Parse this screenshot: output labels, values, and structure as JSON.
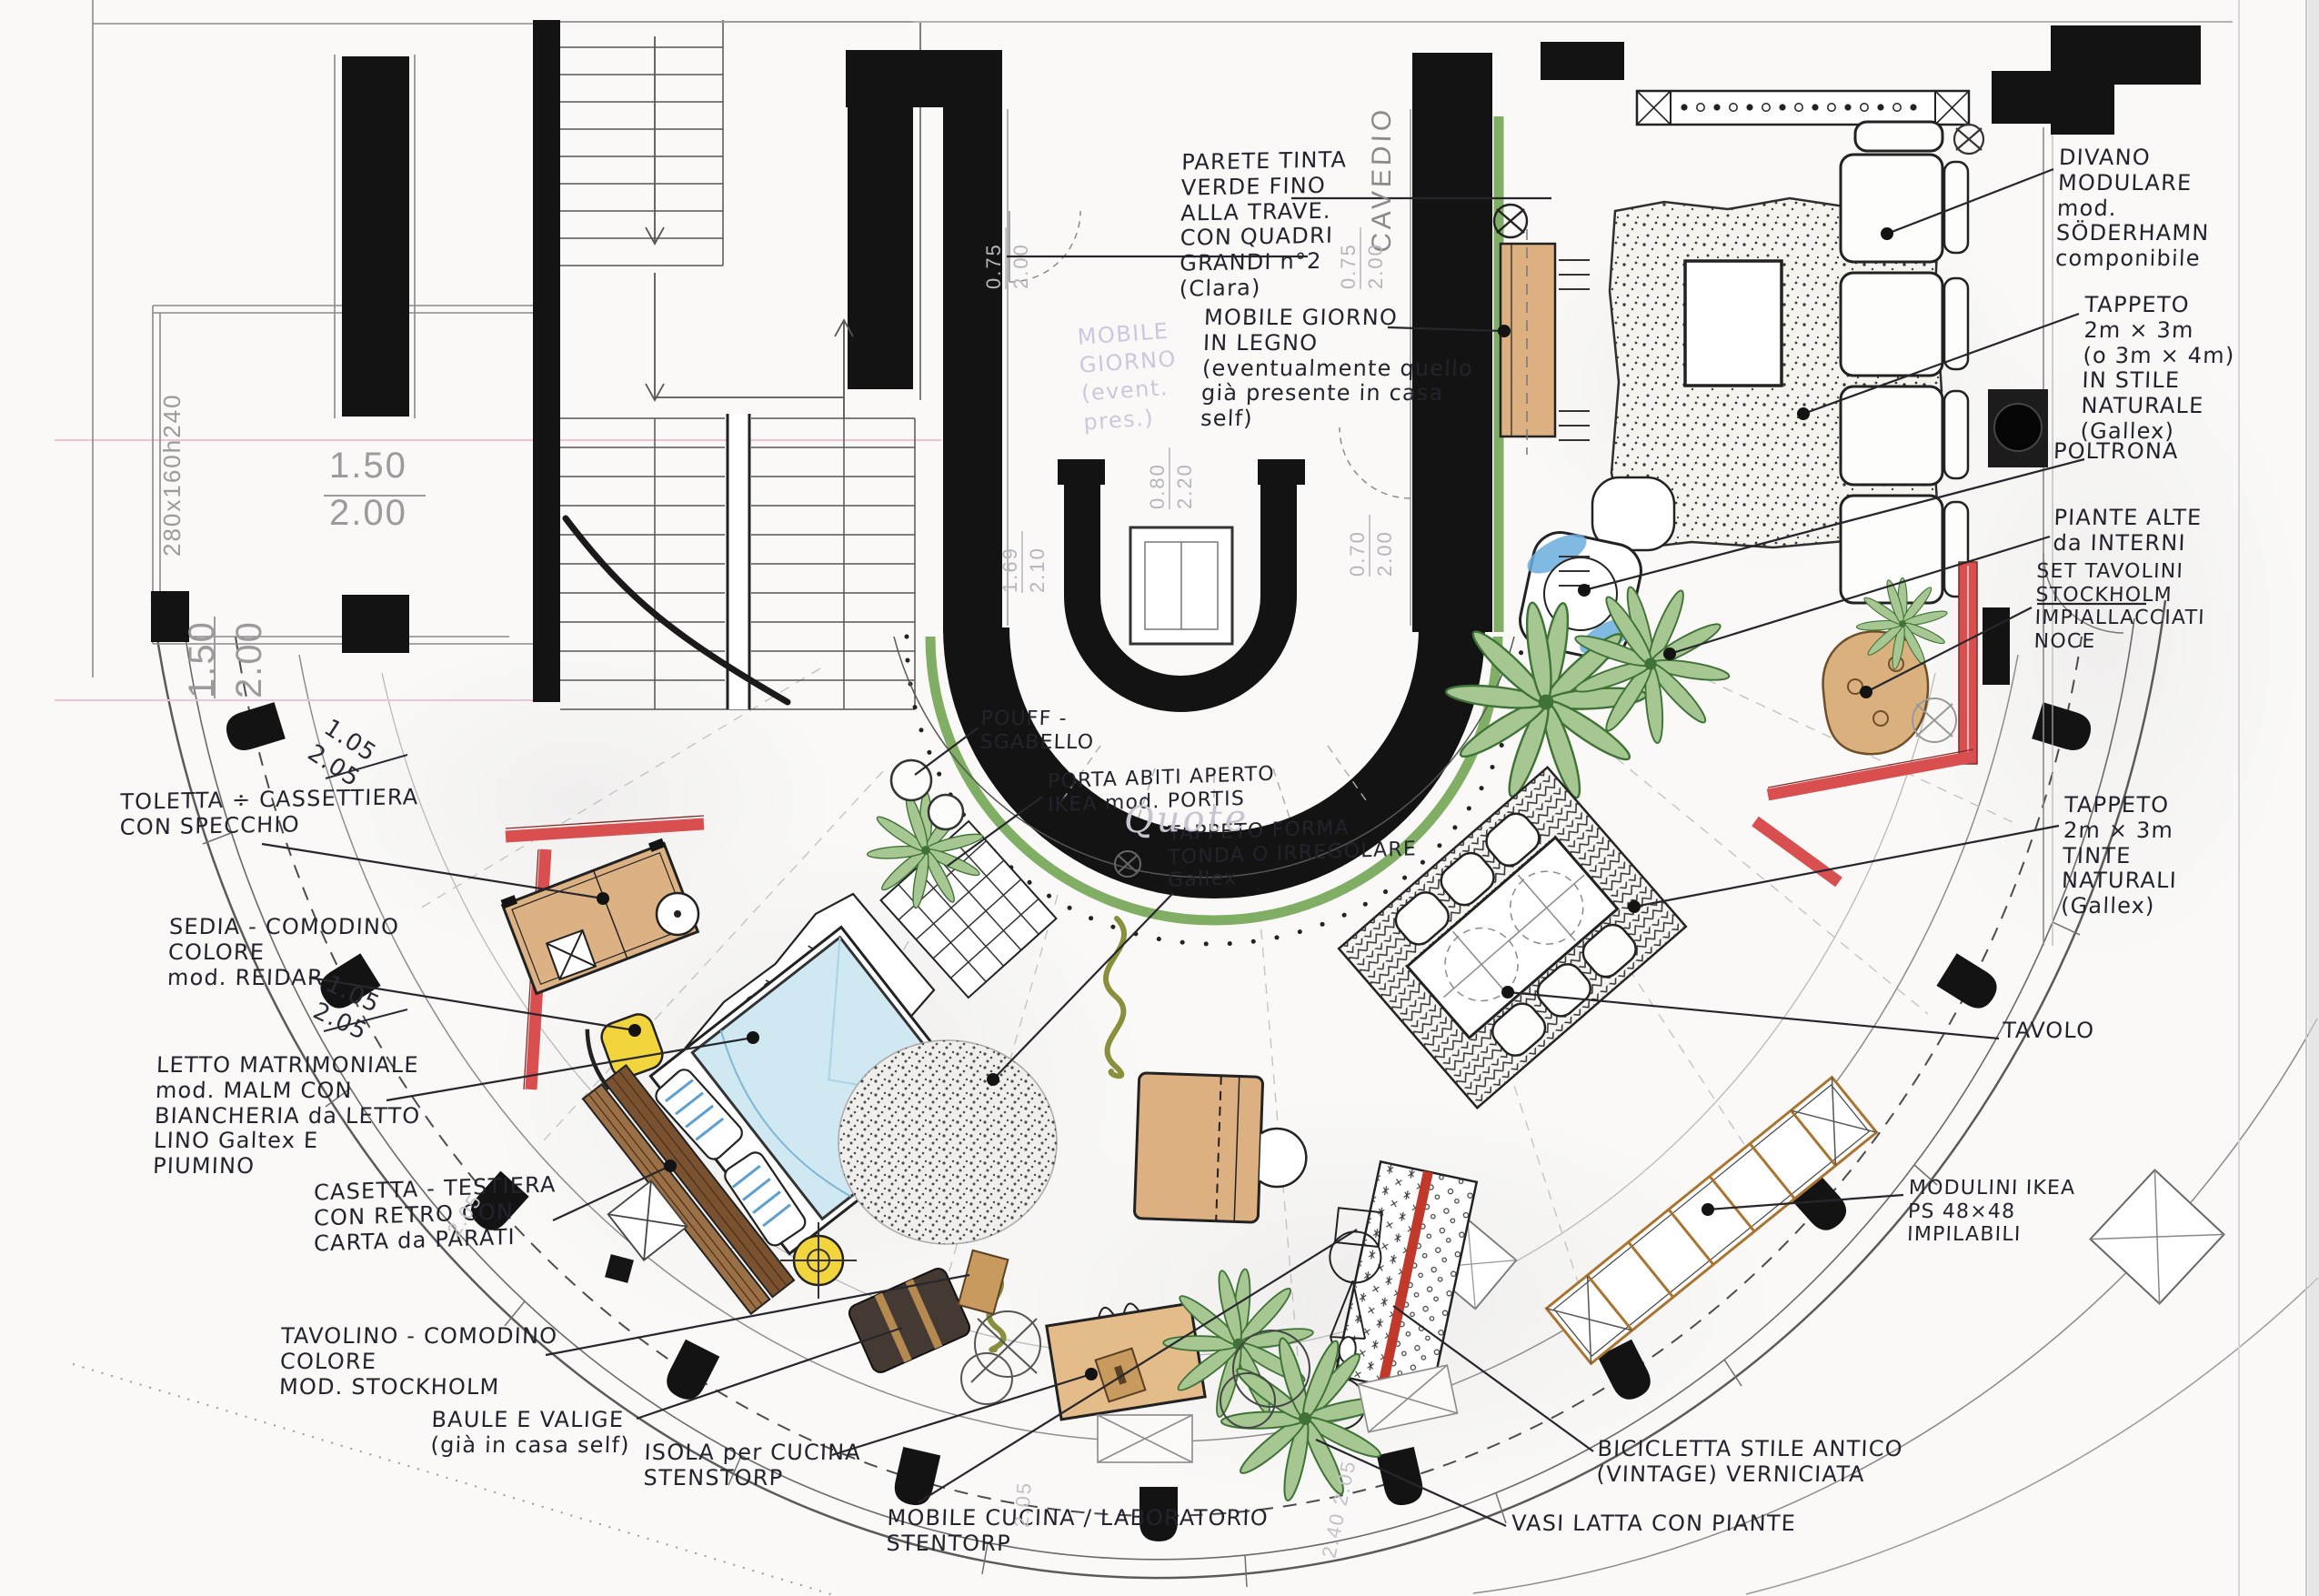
{
  "labels": {
    "parete": "PARETE TINTA\nVERDE FINO\nALLA TRAVE.\nCON QUADRI\nGRANDI n°2\n(Clara)",
    "mobile_giorno": "MOBILE GIORNO\nIN LEGNO\n(eventualmente quello\ngià presente in casa\nself)",
    "cavedio": "CAVEDIO",
    "pouf": "POUFF -\nSGABELLO",
    "porta_abiti": "PORTA ABITI APERTO\nIKEA mod. PORTIS",
    "tappeto_tondo": "TAPPETO FORMA\nTONDA O IRREGOLARE\nGallex",
    "divano": "DIVANO\nMODULARE\nmod.\nSÖDERHAMN\ncomponibile",
    "tappeto_soggiorno": "TAPPETO\n2m × 3m\n(o 3m × 4m)\nIN STILE\nNATURALE\n(Gallex)",
    "poltrona": "POLTRONA",
    "piante_alte": "PIANTE ALTE\nda INTERNI",
    "set_tavolini": "SET TAVOLINI\nSTOCKHOLM\nIMPIALLACCIATI\nNOCE",
    "tappeto_pranzo": "TAPPETO\n2m × 3m\nTINTE\nNATURALI\n(Gallex)",
    "tavolo": "TAVOLO",
    "modulini": "MODULINI IKEA\nPS 48×48\nIMPILABILI",
    "toletta": "TOLETTA ÷ CASSETTIERA\nCON SPECCHIO",
    "sedia": "SEDIA - COMODINO\nCOLORE\nmod. REIDAR",
    "letto": "LETTO MATRIMONIALE\nmod. MALM CON\nBIANCHERIA da LETTO\nLINO Galtex E\nPIUMINO",
    "casetta": "CASETTA - TESTIERA\nCON RETRO CON\nCARTA da PARATI",
    "tavolino": "TAVOLINO - COMODINO\nCOLORE\nMOD. STOCKHOLM",
    "baule": "BAULE E VALIGE\n(già in casa self)",
    "isola": "ISOLA per CUCINA\nSTENSTORP",
    "mobile_cucina": "MOBILE CUCINA / LABORATORIO\nSTENTORP",
    "vasi": "VASI LATTA CON PIANTE",
    "bicicletta": "BICICLETTA STILE ANTICO\n(VINTAGE) VERNICIATA",
    "ghost_note": "MOBILE\nGIORNO\n(event.\npres.)"
  },
  "dimensions": {
    "balcony": "280x160h240",
    "window_a": "1.50\n2.00",
    "window_b": "1.50\n2.00",
    "frac_a": "1.05\n2.05",
    "frac_b": "1.05\n2.05",
    "ghost_a": "0.75\n2.00",
    "ghost_b": "0.75\n2.00",
    "ghost_c": "0.80\n2.20",
    "ghost_d": "0.70\n2.00",
    "ghost_e": "1.69\n2.10",
    "arc_a": "2.05",
    "arc_b": "2.05",
    "arc_c": "2.40  2.05"
  },
  "watermark": "Quote",
  "colors": {
    "wall": "#161616",
    "ink": "#23232e",
    "accent_red": "#d94f4f",
    "accent_green": "#7fae64",
    "wood_tan": "#ddb082",
    "bed_blue": "#cfe8f2",
    "chair_yellow": "#f2d43d",
    "dim_gray": "#9b9b9b"
  }
}
